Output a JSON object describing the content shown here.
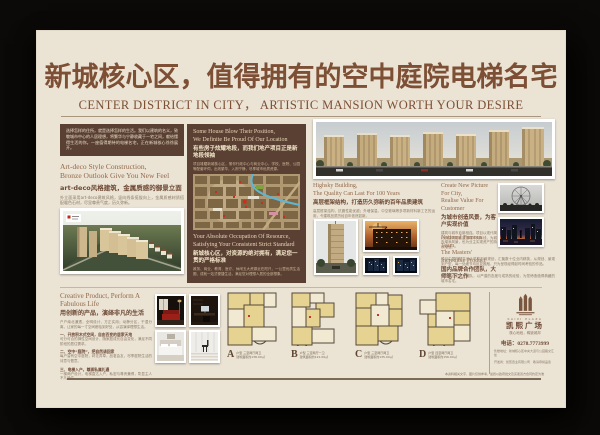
{
  "header": {
    "title_cn": "新城核心区，值得拥有的空中庭院电梯名宅",
    "title_en": "CENTER DISTRICT IN CITY， ARTISTIC MANSION WORTH YOUR DESIRE"
  },
  "artdeco": {
    "intro": "选择怎样的住所，就是选择怎样的生活。我们以建筑的名义，致敬城市中心的人居理想，将繁华与宁静收藏于一宅之间，献给懂得生活的你。一座值得期待的电梯名宅，正在新城核心徐徐展开。",
    "en1": "Art-deco Style Construction,",
    "en2": "Bronze Outlook Give You New Feel",
    "cn": "art-deco风格建筑，金属质感的御景立面",
    "p1": "外立面采用art-deco建筑风格，竖向线条挺拔向上，金属质感材质搭配暖色石材，尽显尊贵气度，历久弥新。",
    "p2": "错落有致的建筑天际线，成就城市中心独具魅力的风景，树立新城人居典范。"
  },
  "location": {
    "en1": "Some House Blow Their Position,",
    "en2": "We Definite Be Proud Of Our Location",
    "cn1": "有些房子炫耀地段，而我们地产项目正是新地段领袖",
    "p1": "项目雄踞新城核心区，紧邻行政中心与商业中心，学校、医院、公园等配套环伺，出则繁华，入则宁静，尽享城市优质资源。",
    "en3": "Your Absolute Occupation Of Resource,",
    "en4": "Satisfying Your Consistent Strict Standard",
    "cn2": "新城核心区，对资源的绝对拥有，满足您一贯的严格标准",
    "p2": "政务、商业、教育、医疗、休闲五大资源近在咫尺，一公里优质生活圈，成就一站式便捷生活，满足您对理想人居的全部想象。"
  },
  "quality": {
    "en1": "Highsky Building,",
    "en2": "The Quality Can Last For 100 Years",
    "cn": "高层框架结构，打造历久弥新的百年品质建筑",
    "p": "高层框架结构，抗震性能优越；外墙保温、中空玻璃等多项新材料新工艺的运用，令建筑品质历经百年依然如新。"
  },
  "vision": {
    "en1": "Create New Picture For City,",
    "en2": "Realise Value For Customer",
    "cn": "为城市创造风景，为客户实现价值",
    "p": "建筑与城市血脉相连。项目以现代简约的建筑语言重塑城市天际线，为城市增添风景，也为业主实现资产的持续增值。"
  },
  "team": {
    "en1": "National Famous Team,",
    "en2": "The Masters' Incredible Product",
    "cn": "国内品牌合作团队，大师笔下之作",
    "p1": "项目由国内知名设计机构担纲规划，汇聚数十位业内精英，从规划、景观到户型，每一处细节均反复推敲，只为呈现经得起时间考验的作品。",
    "p2": "强强联合的开发团队，以严谨的态度与成熟的经验，为您缔造值得典藏的城市名宅。"
  },
  "creative": {
    "en": "Creative Product, Perform A Fabulous Life",
    "cn": "用创新的产品，演绎非凡的生活",
    "intro": "户户南北通透，全明设计，方正实用；动静分区，干湿分离，让家的每一寸空间都恰到好处，从容演绎理想生活。",
    "items": [
      {
        "t": "一、开放积木式空间，自由百变的居家天地",
        "p": "可分可合的弹性空间设计，随家庭成长自由变化，满足不同阶段的居住需求。"
      },
      {
        "t": "二、空中“庭院”，把自然请回家",
        "p": "每户皆有空中庭院，莳花弄草，品茗会友，尽享庭院生活的诗意与惬意。"
      },
      {
        "t": "三、电梯入户，尊崇私属礼遇",
        "p": "一梯两户设计，电梯直达入户，私密与尊贵兼得，彰显主人不凡品位。"
      }
    ]
  },
  "floorplans": [
    {
      "letter": "A",
      "name": "户型 三室两厅两卫",
      "area": "建筑面积约138.00㎡"
    },
    {
      "letter": "B",
      "name": "户型 三室两厅一卫",
      "area": "建筑面积约121.00㎡"
    },
    {
      "letter": "C",
      "name": "户型 三室两厅两卫",
      "area": "建筑面积约135.00㎡"
    },
    {
      "letter": "D",
      "name": "户型 四室两厅两卫",
      "area": "建筑面积约156.00㎡"
    }
  ],
  "brand": {
    "en": "KAIXI PLAZA",
    "cn": "凯熙广场",
    "tagline": "核心地段，稀缺城邦",
    "phone": "电话：0278.7773999",
    "addr1": "售楼地址：新城核心区中央大道与公园路交汇处",
    "addr2": "开发商：凯熙置业有限公司　敬请恭候品鉴"
  },
  "footer": {
    "disclaimer": "本资料相关文字、图片仅供参考，最终以政府批文及买卖双方合同约定为准"
  }
}
